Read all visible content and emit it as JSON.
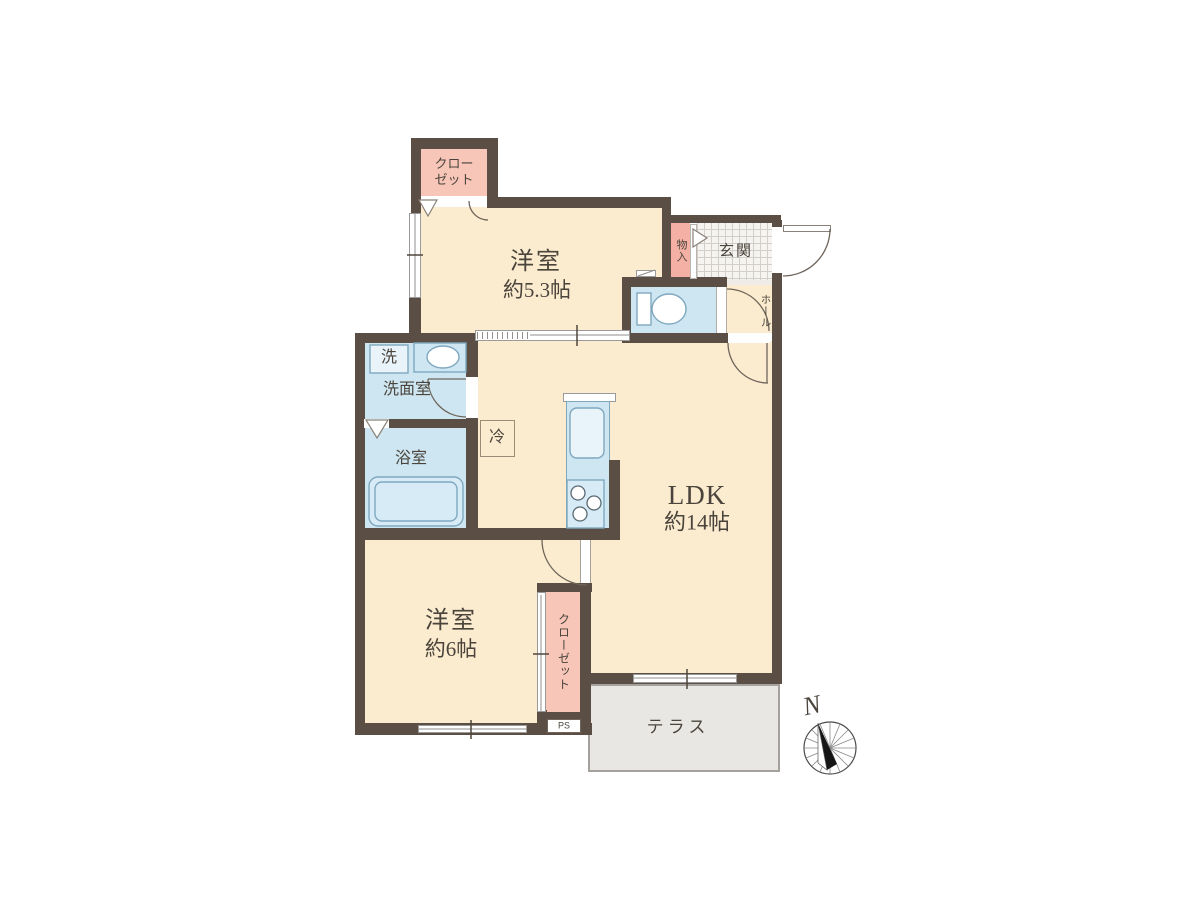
{
  "rooms": {
    "closet_top": {
      "line1": "クロー",
      "line2": "ゼット"
    },
    "bedroom_53": {
      "name": "洋室",
      "size": "約5.3帖"
    },
    "storage": {
      "label": "物入"
    },
    "entrance": {
      "label": "玄関"
    },
    "hall": {
      "label": "ホール"
    },
    "washer": {
      "label": "洗"
    },
    "washroom": {
      "label": "洗面室"
    },
    "bathroom": {
      "label": "浴室"
    },
    "refrigerator": {
      "label": "冷"
    },
    "ldk": {
      "name": "LDK",
      "size": "約14帖"
    },
    "bedroom_6": {
      "name": "洋室",
      "size": "約6帖"
    },
    "closet_bottom": {
      "col1": "クロー",
      "col2": "ゼット"
    },
    "pipe_space": {
      "label": "PS"
    },
    "terrace": {
      "label": "テラス"
    }
  },
  "compass": {
    "north_label": "N"
  },
  "colors": {
    "wall": "#5b4f45",
    "floor": "#fceccf",
    "wet_area": "#cde6f2",
    "closet_pink": "#f8c6b8",
    "storage_pink": "#f4b0a4",
    "terrace_gray": "#e9e7e3"
  }
}
